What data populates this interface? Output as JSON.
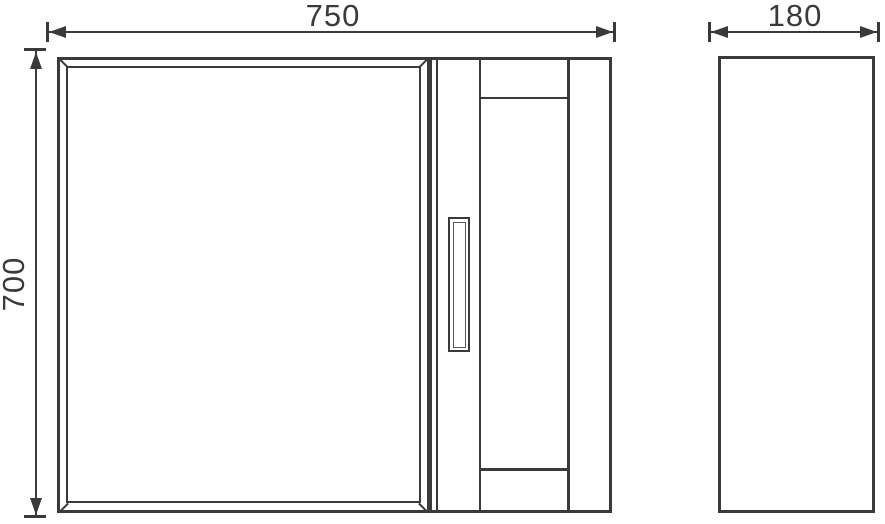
{
  "drawing": {
    "type": "furniture dimension drawing",
    "line_color": "#3a3a3a",
    "background_color": "#ffffff",
    "dimensions": {
      "front_width": "750",
      "front_height": "700",
      "side_depth": "180"
    },
    "views": {
      "front": "cabinet front with bevelled mirror door, handle and open side shelves",
      "side": "plain side panel"
    }
  }
}
